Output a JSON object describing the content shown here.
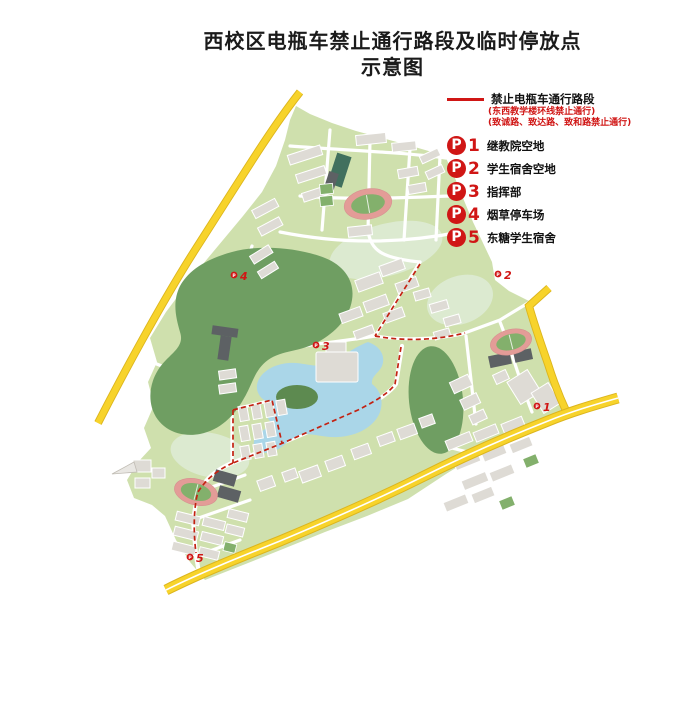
{
  "title": {
    "line1": "西校区电瓶车禁止通行路段及临时停放点",
    "line2": "示意图"
  },
  "legend": {
    "badge_letter": "P",
    "route": {
      "label": "禁止电瓶车通行路段",
      "note1": "(东西教学楼环线禁止通行)",
      "note2": "(致诚路、致达路、致和路禁止通行)"
    },
    "parking_points": [
      {
        "num": "1",
        "label": "继教院空地"
      },
      {
        "num": "2",
        "label": "学生宿舍空地"
      },
      {
        "num": "3",
        "label": "指挥部"
      },
      {
        "num": "4",
        "label": "烟草停车场"
      },
      {
        "num": "5",
        "label": "东糖学生宿舍"
      }
    ]
  },
  "map": {
    "markers": [
      {
        "num": "1"
      },
      {
        "num": "2"
      },
      {
        "num": "3"
      },
      {
        "num": "4"
      },
      {
        "num": "5"
      }
    ]
  },
  "colors": {
    "accent-red": "#d01615",
    "dashed-red": "#c32212",
    "road-yellow": "#f7d32b",
    "road-yellow-edge": "#dcb51d",
    "campus-green": "#cfe0ad",
    "campus-green-light": "#dcead0",
    "hill-green": "#6f9e62",
    "lake-blue": "#aad6e8",
    "building-gray": "#dedbd5",
    "dark-building": "#5d6164",
    "track-pink": "#e39c97",
    "field-green": "#83b06c",
    "court-teal": "#41705e"
  }
}
